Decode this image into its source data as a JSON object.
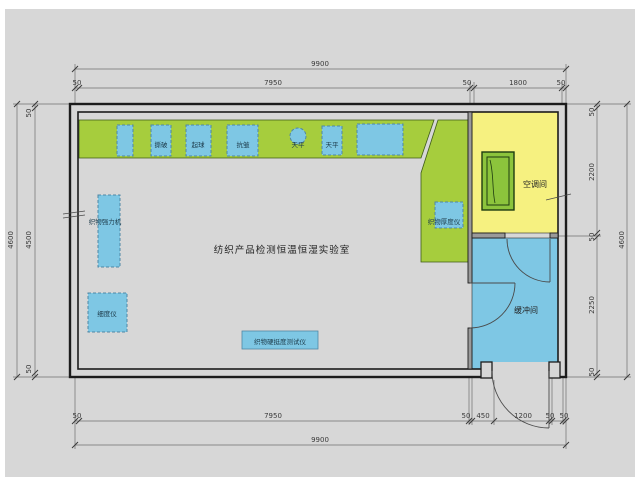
{
  "title": {
    "lab_room": "纺织产品检测恒温恒湿实验室"
  },
  "rooms": {
    "ac": "空调间",
    "buffer": "缓冲间"
  },
  "equipment": {
    "bench_1": "撕破",
    "bench_2": "起球",
    "bench_3": "抗皱",
    "balance_round": "天平",
    "balance_box": "天平",
    "strength": "织物强力机",
    "fineness": "细度仪",
    "stiffness": "织物硬挺度测试仪",
    "thickness": "织物厚度仪"
  },
  "dimensions": {
    "top": {
      "overall": "9900",
      "seg_50_a": "50",
      "seg_main": "7950",
      "seg_50_b": "50",
      "seg_ac": "1800",
      "seg_50_c": "50"
    },
    "bottom": {
      "overall": "9900",
      "seg_50_a": "50",
      "seg_main": "7950",
      "seg_50_b": "50",
      "seg_450": "450",
      "seg_door": "1200",
      "seg_50_c": "50",
      "seg_50_d": "50"
    },
    "left": {
      "overall": "4600",
      "seg_50_top": "50",
      "seg_main": "4500",
      "seg_50_bottom": "50"
    },
    "right": {
      "overall": "4600",
      "seg_50_top": "50",
      "seg_ac": "2200",
      "seg_50_mid": "50",
      "seg_buffer": "2250",
      "seg_50_bottom": "50"
    }
  },
  "colors": {
    "paper": "#d7d7d7",
    "counter": "#a6cd3d",
    "counter_edge": "#3f5c17",
    "equipment": "#7ec7e4",
    "ac_room": "#f6f180",
    "buffer_room": "#7ec7e4",
    "ac_unit": "#8cc43c",
    "wall": "#1c1c1c"
  }
}
